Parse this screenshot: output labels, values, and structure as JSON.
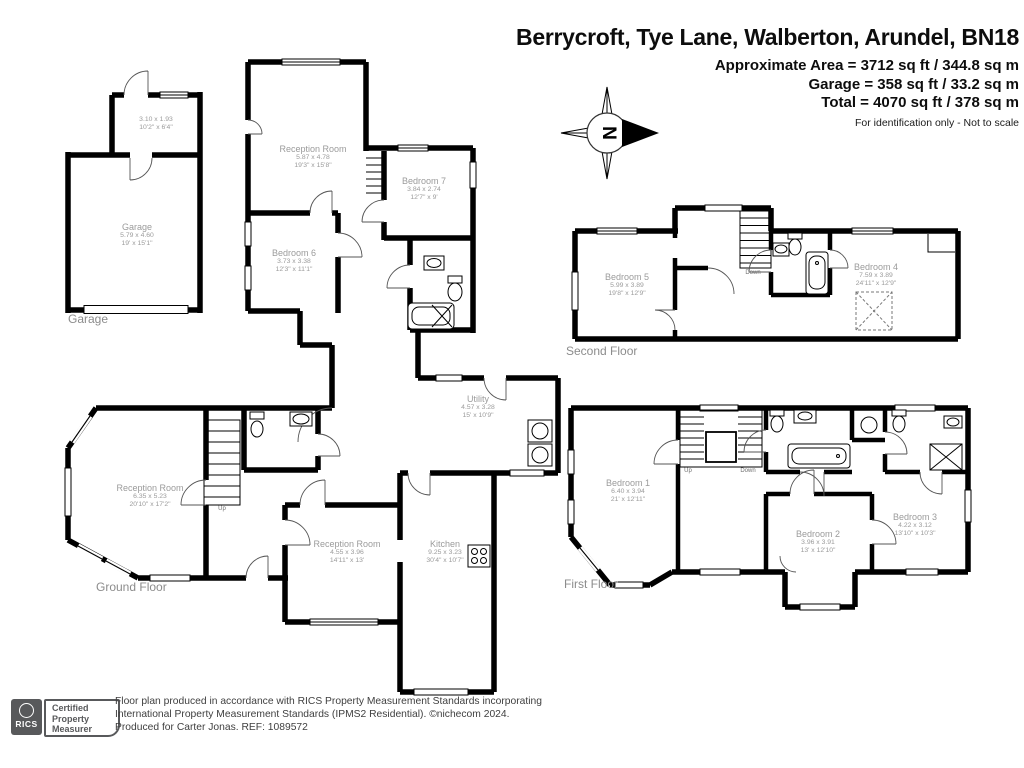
{
  "header": {
    "title": "Berrycroft, Tye Lane, Walberton, Arundel, BN18",
    "area_lines": [
      "Approximate Area = 3712 sq ft / 344.8 sq m",
      "Garage = 358 sq ft / 33.2 sq m",
      "Total = 4070 sq ft / 378 sq m"
    ],
    "disclaimer": "For identification only - Not to scale"
  },
  "compass": {
    "letter": "N"
  },
  "floors": {
    "garage": {
      "caption": "Garage",
      "rooms": [
        {
          "name": "",
          "metric": "3.10 x 1.93",
          "imperial": "10'2\" x 6'4\""
        },
        {
          "name": "Garage",
          "metric": "5.79 x 4.60",
          "imperial": "19' x 15'1\""
        }
      ]
    },
    "ground": {
      "caption": "Ground Floor",
      "stairs_label": "Up",
      "rooms": [
        {
          "name": "Reception Room",
          "metric": "5.87 x 4.78",
          "imperial": "19'3\" x 15'8\""
        },
        {
          "name": "Bedroom 7",
          "metric": "3.84 x 2.74",
          "imperial": "12'7\" x 9'"
        },
        {
          "name": "Bedroom 6",
          "metric": "3.73 x 3.38",
          "imperial": "12'3\" x 11'1\""
        },
        {
          "name": "Reception Room",
          "metric": "6.35 x 5.23",
          "imperial": "20'10\" x 17'2\""
        },
        {
          "name": "Reception Room",
          "metric": "4.55 x 3.96",
          "imperial": "14'11\" x 13'"
        },
        {
          "name": "Kitchen",
          "metric": "9.25 x 3.23",
          "imperial": "30'4\" x 10'7\""
        },
        {
          "name": "Utility",
          "metric": "4.57 x 3.28",
          "imperial": "15' x 10'9\""
        }
      ]
    },
    "second": {
      "caption": "Second Floor",
      "stairs_label": "Down",
      "rooms": [
        {
          "name": "Bedroom 5",
          "metric": "5.99 x 3.89",
          "imperial": "19'8\" x 12'9\""
        },
        {
          "name": "Bedroom 4",
          "metric": "7.59 x 3.89",
          "imperial": "24'11\" x 12'9\""
        }
      ]
    },
    "first": {
      "caption": "First Floor",
      "stairs_up_label": "Up",
      "stairs_down_label": "Down",
      "rooms": [
        {
          "name": "Bedroom 1",
          "metric": "6.40 x 3.94",
          "imperial": "21' x 12'11\""
        },
        {
          "name": "Bedroom 2",
          "metric": "3.96 x 3.91",
          "imperial": "13' x 12'10\""
        },
        {
          "name": "Bedroom 3",
          "metric": "4.22 x 3.12",
          "imperial": "13'10\" x 10'3\""
        }
      ]
    }
  },
  "footer": {
    "rics_label": "RICS",
    "badge_lines": [
      "Certified",
      "Property",
      "Measurer"
    ],
    "lines": [
      "Floor plan produced in accordance with RICS Property Measurement Standards incorporating",
      "International Property Measurement Standards (IPMS2 Residential).  ©nichecom 2024.",
      "Produced for Carter Jonas.  REF: 1089572"
    ]
  }
}
